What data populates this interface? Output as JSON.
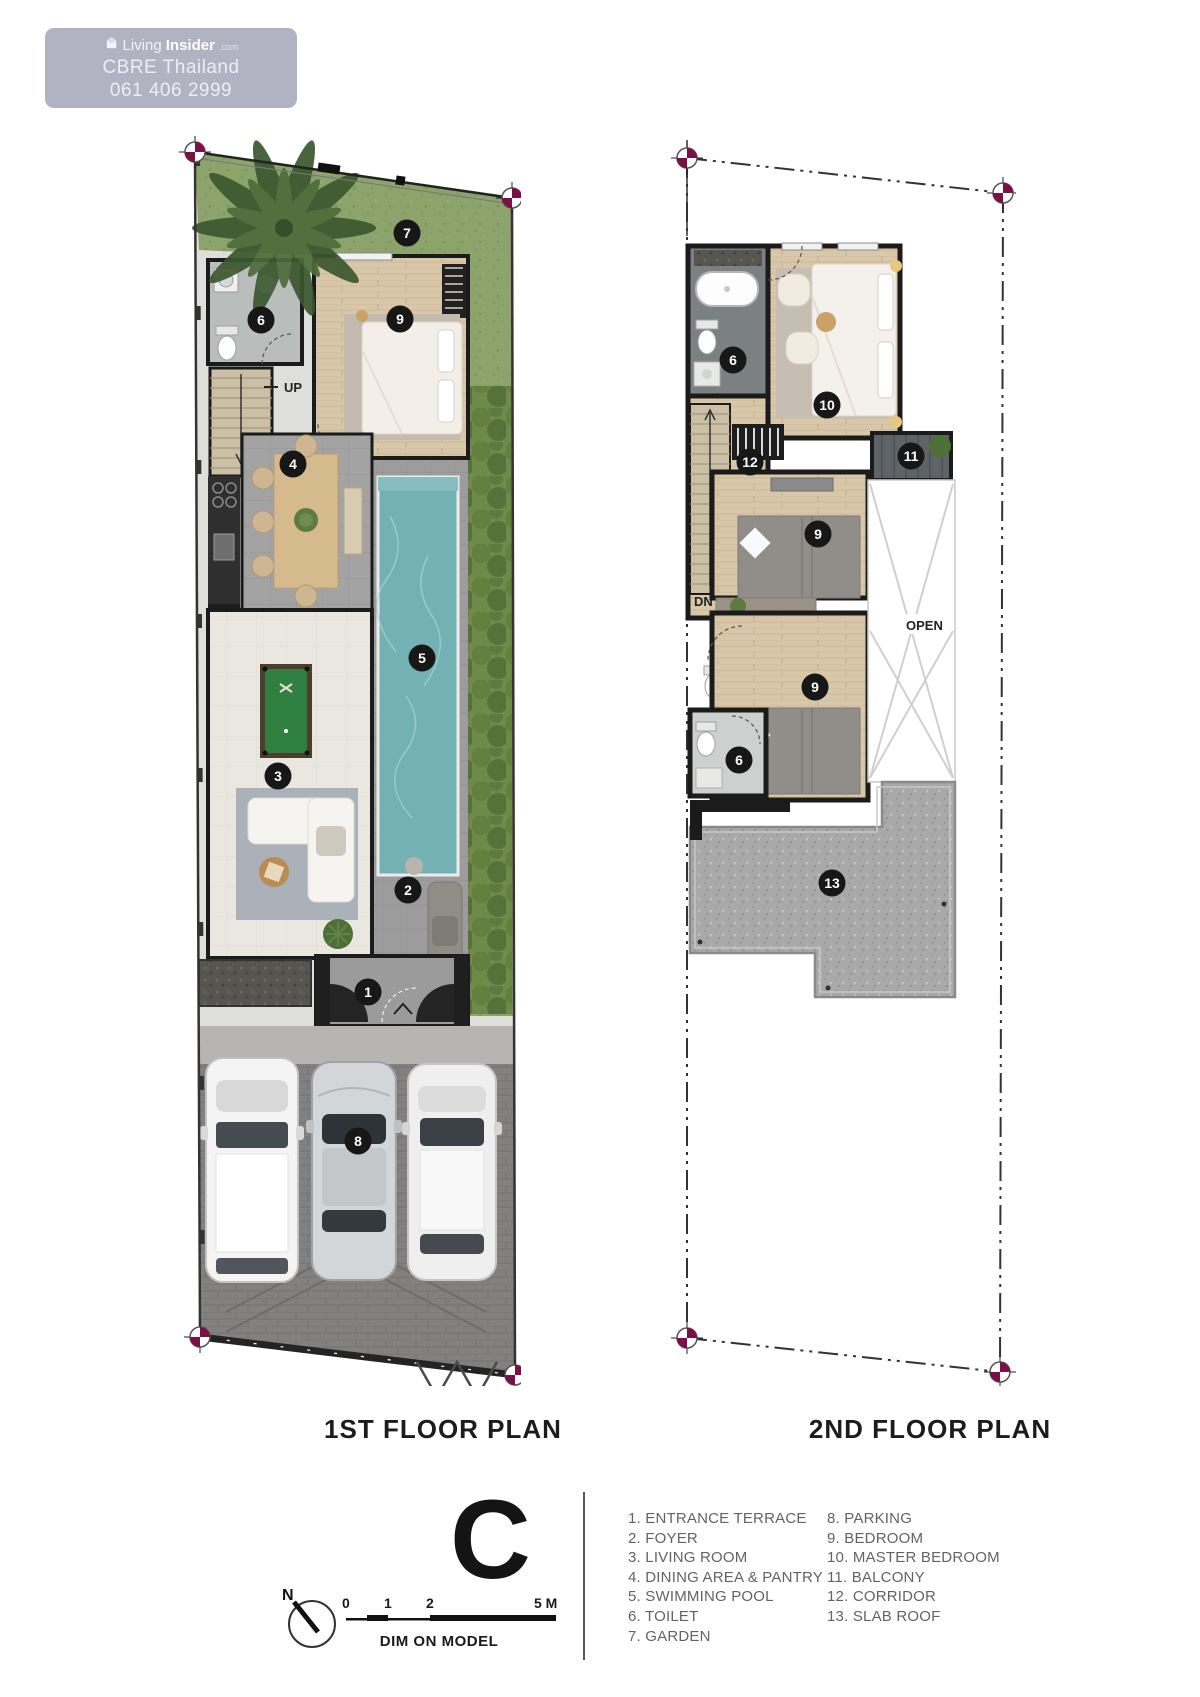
{
  "watermark": {
    "brand_prefix": "Living",
    "brand_bold": "Insider",
    "brand_suffix": ".com",
    "line2": "CBRE Thailand",
    "line3": "061 406 2999"
  },
  "floor1": {
    "title": "1ST FLOOR PLAN",
    "badges": {
      "garden": "7",
      "toilet": "6",
      "bedroom": "9",
      "dining": "4",
      "pool": "5",
      "living": "3",
      "foyer": "2",
      "entrance": "1",
      "parking": "8"
    },
    "labels": {
      "stairs_up": "UP",
      "entrance_up": "UP"
    }
  },
  "floor2": {
    "title": "2ND FLOOR PLAN",
    "badges": {
      "bath_top": "6",
      "master_bedroom": "10",
      "corridor": "12",
      "balcony": "11",
      "bedroom_front": "9",
      "bedroom_mid": "9",
      "bath_low": "6",
      "slab_roof": "13"
    },
    "labels": {
      "stairs_dn": "DN",
      "void": "OPEN"
    }
  },
  "legend": {
    "col1": [
      "1. ENTRANCE TERRACE",
      "2. FOYER",
      "3. LIVING ROOM",
      "4. DINING AREA & PANTRY",
      "5. SWIMMING POOL",
      "6. TOILET",
      "7. GARDEN"
    ],
    "col2": [
      "8. PARKING",
      "9. BEDROOM",
      "10. MASTER BEDROOM",
      "11. BALCONY",
      "12. CORRIDOR",
      "13. SLAB ROOF"
    ]
  },
  "plan_type": "C",
  "compass": {
    "north": "N"
  },
  "scalebar": {
    "ticks": [
      "0",
      "1",
      "2",
      "5 M"
    ],
    "note": "DIM ON MODEL"
  },
  "colors": {
    "pool": "#74b1b5",
    "grass": "#8ca36b",
    "hedge": "#668242",
    "wood": "#d9c7a9",
    "survey_marker": "#7c0f45",
    "wall": "#1b1b1b"
  }
}
